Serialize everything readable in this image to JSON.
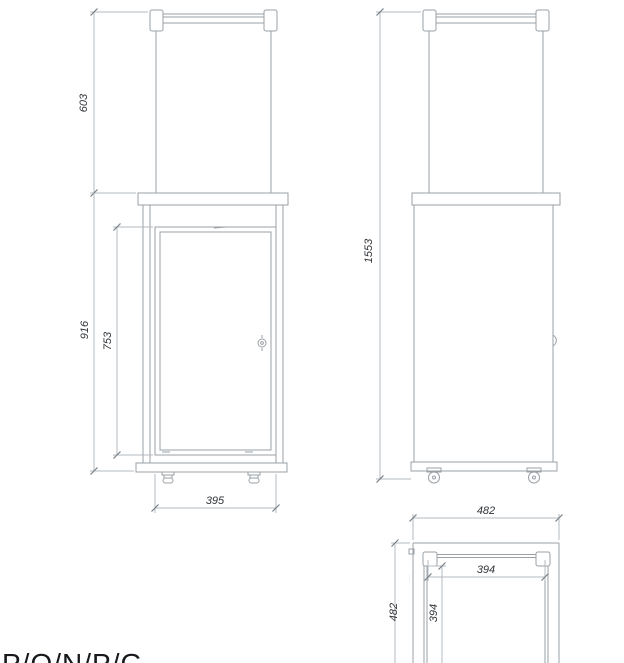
{
  "front_view": {
    "dim_top_section": "603",
    "dim_glass": "916",
    "dim_door": "753",
    "dim_width": "395"
  },
  "side_view": {
    "dim_total_height": "1553"
  },
  "top_view": {
    "dim_base_width": "482",
    "dim_base_depth": "482",
    "dim_body_width": "394",
    "dim_body_depth": "394",
    "micro_label": "·····"
  },
  "bottom_label": "P/O/N/P/G",
  "colors": {
    "object_line": "#9aa0a6",
    "dimension_line": "#b6bbc0",
    "dimension_text": "#303438",
    "label_text": "#17191c",
    "background": "#ffffff"
  }
}
